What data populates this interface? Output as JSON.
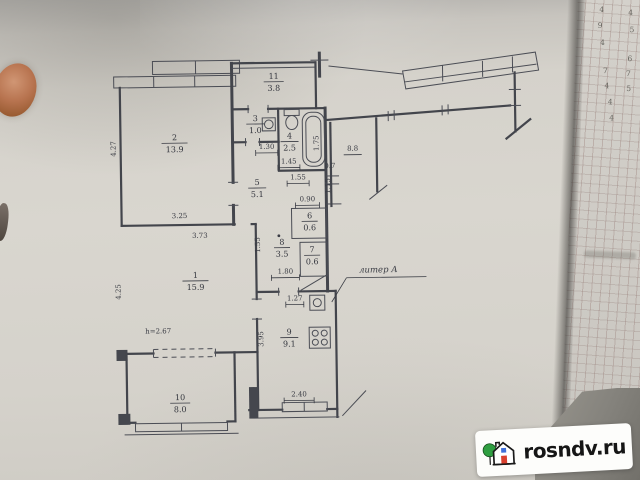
{
  "watermark": {
    "brand": "rosndv.ru",
    "tree_color": "#2f9e41",
    "door_color": "#d9402e",
    "window_color": "#3f6fd8"
  },
  "plan": {
    "rooms": [
      {
        "num": "2",
        "area": "13.9",
        "x": 76,
        "y": 92,
        "w": 13
      },
      {
        "num": "11",
        "area": "3.8",
        "x": 176,
        "y": 32,
        "w": 10
      },
      {
        "num": "3",
        "area": "1.0",
        "x": 157,
        "y": 74,
        "w": 9
      },
      {
        "num": "4",
        "area": "2.5",
        "x": 191,
        "y": 92,
        "w": 9
      },
      {
        "num": "5",
        "area": "5.1",
        "x": 158,
        "y": 138,
        "w": 9
      },
      {
        "num": "6",
        "area": "0.6",
        "x": 210,
        "y": 172,
        "w": 8
      },
      {
        "num": "7",
        "area": "0.6",
        "x": 212,
        "y": 206,
        "w": 8
      },
      {
        "num": "8",
        "area": "3.5",
        "x": 182,
        "y": 198,
        "w": 8
      },
      {
        "num": "1",
        "area": "15.9",
        "x": 95,
        "y": 230,
        "w": 13
      },
      {
        "num": "9",
        "area": "9.1",
        "x": 188,
        "y": 288,
        "w": 9
      },
      {
        "num": "10",
        "area": "8.0",
        "x": 78,
        "y": 352,
        "w": 10
      }
    ],
    "dims": [
      {
        "t": "4.27",
        "x": 17,
        "y": 100,
        "r": -90
      },
      {
        "t": "3.25",
        "x": 80,
        "y": 170
      },
      {
        "t": "3.73",
        "x": 100,
        "y": 190
      },
      {
        "t": "4.25",
        "x": 20,
        "y": 243,
        "r": -90
      },
      {
        "t": "1.30",
        "x": 168,
        "y": 102,
        "u": 1,
        "w": 11
      },
      {
        "t": "1.45",
        "x": 190,
        "y": 117,
        "u": 1,
        "w": 11
      },
      {
        "t": "1.55",
        "x": 199,
        "y": 133,
        "u": 1,
        "w": 11
      },
      {
        "t": "1.75",
        "x": 220,
        "y": 97,
        "r": -90
      },
      {
        "t": "1.15",
        "x": 231,
        "y": 140,
        "r": -90
      },
      {
        "t": "0.7",
        "x": 231,
        "y": 122
      },
      {
        "t": "0.90",
        "x": 208,
        "y": 155,
        "u": 1,
        "w": 12
      },
      {
        "t": "1.55",
        "x": 160,
        "y": 198,
        "r": -90
      },
      {
        "t": "1.80",
        "x": 185,
        "y": 227,
        "u": 1,
        "w": 14
      },
      {
        "t": "1.27",
        "x": 194,
        "y": 254,
        "u": 1,
        "w": 9
      },
      {
        "t": "3.95",
        "x": 162,
        "y": 292,
        "r": -90
      },
      {
        "t": "2.40",
        "x": 197,
        "y": 350,
        "u": 1,
        "w": 15
      }
    ],
    "notes": {
      "liter": "литер А",
      "height": "h=2.67",
      "neighbor_area": "8.8"
    }
  },
  "side_sheet": {
    "digits": [
      "4",
      "4",
      "9",
      "5",
      "4",
      "6",
      "7",
      "7",
      "4",
      "5",
      "4",
      "4"
    ]
  }
}
